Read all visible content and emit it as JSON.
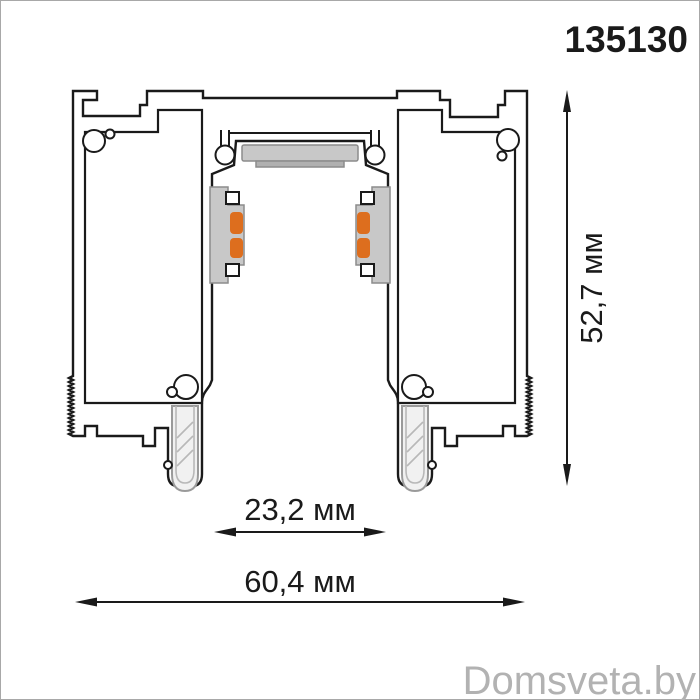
{
  "product_code": "135130",
  "watermark": "Domsveta.by",
  "dimensions": {
    "height_label": "52,7 мм",
    "inner_width_label": "23,2 мм",
    "outer_width_label": "60,4 мм"
  },
  "colors": {
    "outline": "#1a1a1a",
    "contact_orange": "#dd6e1e",
    "component_gray": "#c8c8c8",
    "magnet_gray": "#c8c8c8",
    "magnet_base_gray": "#b0b0b0",
    "gasket_fill": "#f1f1f1",
    "watermark_gray": "#b2b2b2"
  }
}
